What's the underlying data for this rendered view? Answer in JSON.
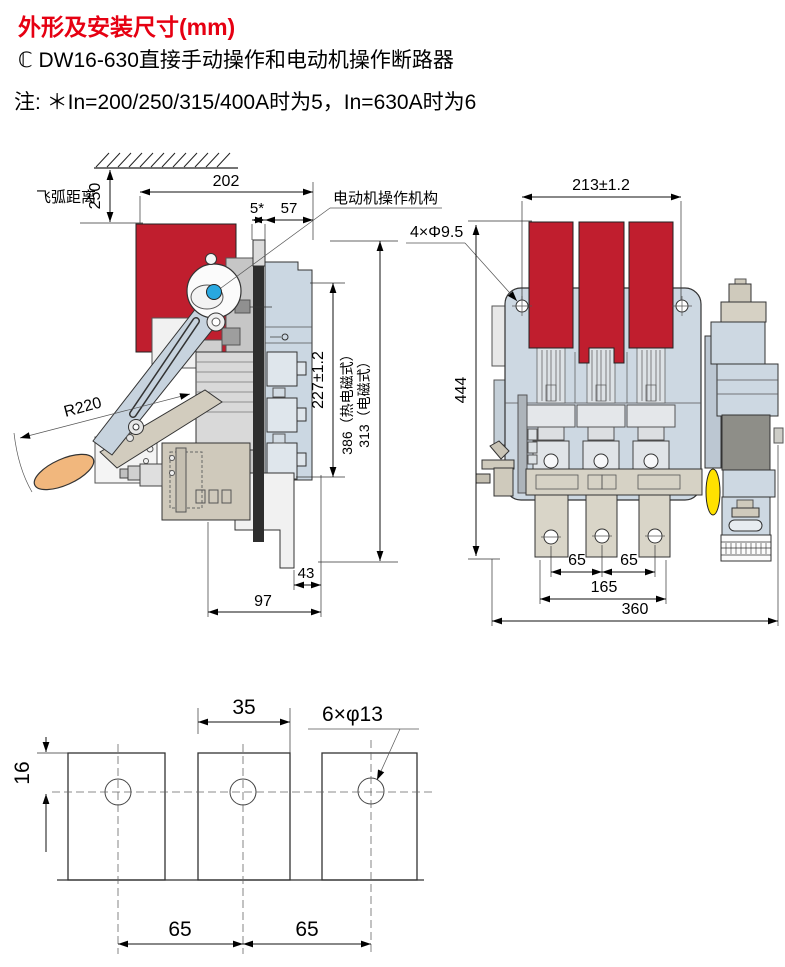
{
  "header": {
    "title": "外形及安装尺寸(mm)",
    "subtitle": "ℂ DW16-630直接手动操作和电动机操作断路器",
    "note": "注: ＊In=200/250/315/400A时为5，In=630A时为6"
  },
  "colors": {
    "title_red": "#e60012",
    "arc_chute_red": "#c01e2e",
    "body_blue": "#cdd8e2",
    "panel_blue": "#cbd7e2",
    "handle_blue": "#c7d3de",
    "grip_orange": "#f1b77d",
    "knob_blue": "#29a8e0",
    "indicator_yellow": "#ffe100",
    "base_tan": "#cfc9bb",
    "dark_bar": "#2e2e2e"
  },
  "left_view": {
    "labels": {
      "arc_distance": "飞弧距离",
      "motor_mechanism": "电动机操作机构"
    },
    "dims": {
      "d250": "250",
      "d202": "202",
      "d5": "5*",
      "d57": "57",
      "r220": "R220",
      "d227": "227±1.2",
      "d386": "386（热电磁式）",
      "d313": "313（电磁式）",
      "d43": "43",
      "d97": "97"
    }
  },
  "right_view": {
    "dims": {
      "d213": "213±1.2",
      "holes": "4×Φ9.5",
      "d444": "444",
      "d65a": "65",
      "d65b": "65",
      "d165": "165",
      "d360": "360"
    }
  },
  "bottom_view": {
    "dims": {
      "d35": "35",
      "holes": "6×φ13",
      "d16": "16",
      "d65a": "65",
      "d65b": "65"
    }
  }
}
